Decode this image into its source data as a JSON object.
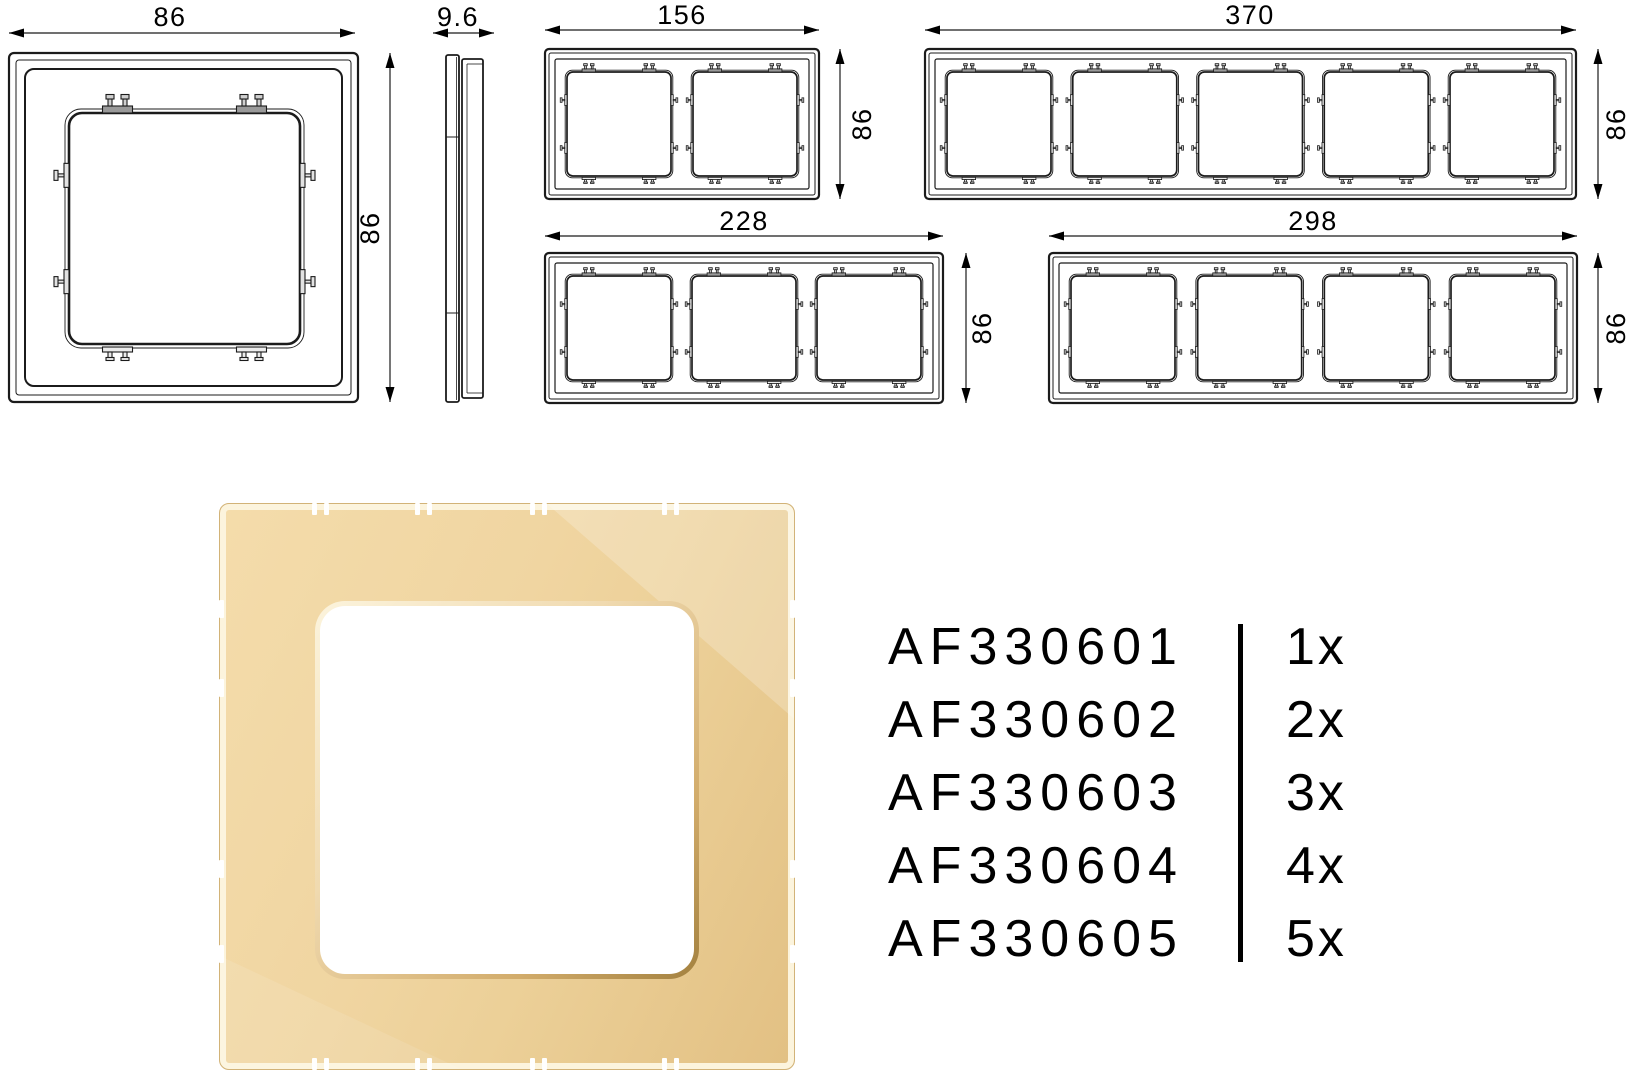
{
  "diagram": {
    "front_view": {
      "width_label": "86",
      "height_label": "86"
    },
    "side_view": {
      "depth_label": "9.6"
    },
    "frames": [
      {
        "gangs": 2,
        "width_label": "156",
        "height_label": "86"
      },
      {
        "gangs": 5,
        "width_label": "370",
        "height_label": "86"
      },
      {
        "gangs": 3,
        "width_label": "228",
        "height_label": "86"
      },
      {
        "gangs": 4,
        "width_label": "298",
        "height_label": "86"
      }
    ]
  },
  "product_render": {
    "frame_color_light": "#f4dcab",
    "frame_color_mid": "#f0d5a1",
    "frame_color_dark": "#e2c083",
    "edge_highlight": "#fcf4dd",
    "rim_dark": "#a3813f",
    "opening_color": "#ffffff"
  },
  "catalog": {
    "text_color": "#000000",
    "items": [
      {
        "code": "AF330601",
        "qty": "1x"
      },
      {
        "code": "AF330602",
        "qty": "2x"
      },
      {
        "code": "AF330603",
        "qty": "3x"
      },
      {
        "code": "AF330604",
        "qty": "4x"
      },
      {
        "code": "AF330605",
        "qty": "5x"
      }
    ]
  }
}
